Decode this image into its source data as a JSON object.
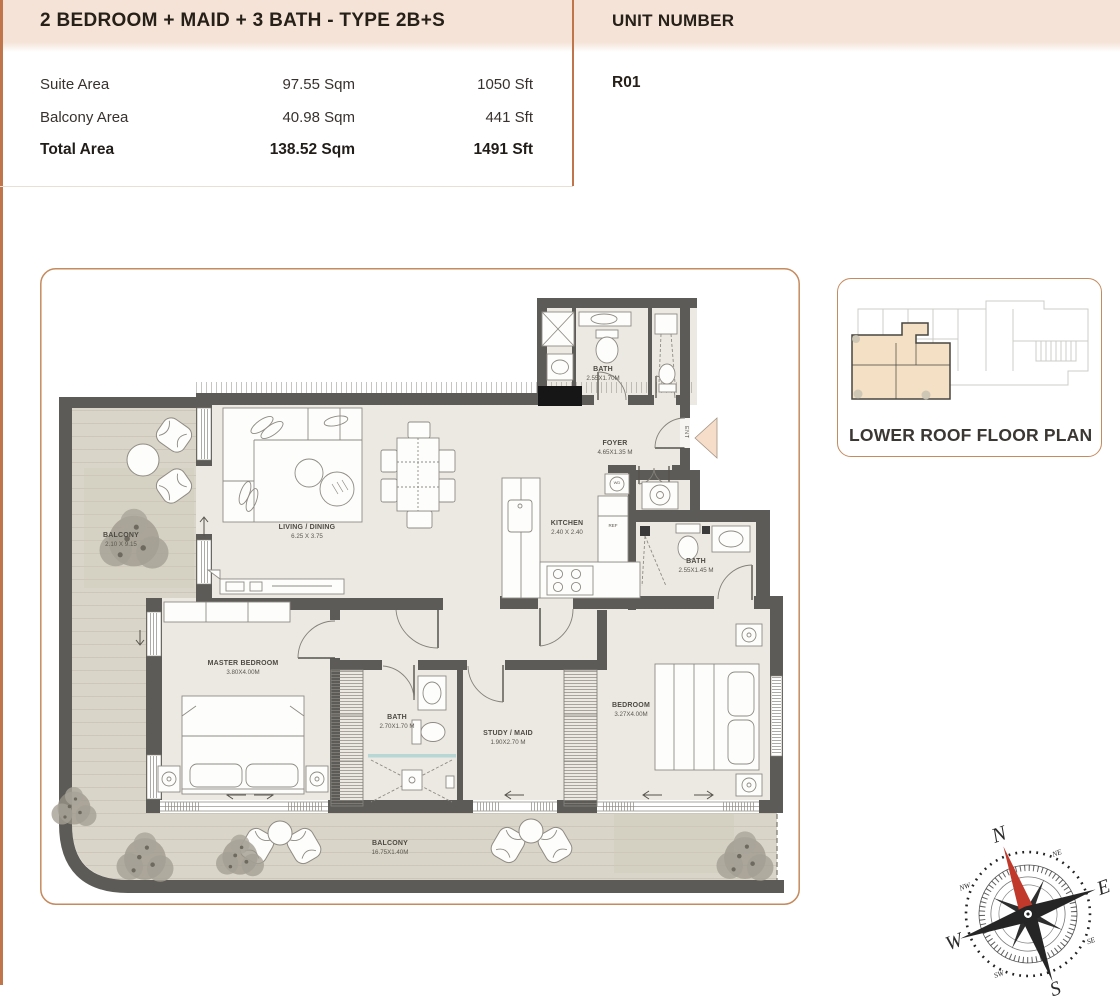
{
  "header": {
    "title": "2 BEDROOM  + MAID + 3 BATH - TYPE 2B+S",
    "unit": {
      "label": "UNIT NUMBER",
      "value": "R01"
    },
    "area_rows": [
      {
        "label": "Suite Area",
        "sqm": "97.55 Sqm",
        "sft": "1050 Sft"
      },
      {
        "label": "Balcony Area",
        "sqm": "40.98 Sqm",
        "sft": "441 Sft"
      },
      {
        "label": "Total Area",
        "sqm": "138.52 Sqm",
        "sft": "1491 Sft"
      }
    ]
  },
  "key_plan": {
    "caption": "LOWER ROOF FLOOR PLAN"
  },
  "compass": {
    "n": "N",
    "e": "E",
    "s": "S",
    "w": "W",
    "ne": "NE",
    "se": "SE",
    "sw": "SW",
    "nw": "NW"
  },
  "plan": {
    "rooms": {
      "balcony_left": {
        "name": "BALCONY",
        "dim": "2.10 X 9.15"
      },
      "living": {
        "name": "LIVING / DINING",
        "dim": "6.25 X 3.75"
      },
      "bath_top": {
        "name": "BATH",
        "dim": "2.55X1.70M"
      },
      "foyer": {
        "name": "FOYER",
        "dim": "4.65X1.35 M"
      },
      "kitchen": {
        "name": "KITCHEN",
        "dim": "2.40 X 2.40"
      },
      "bath_right": {
        "name": "BATH",
        "dim": "2.55X1.45 M"
      },
      "master_bedroom": {
        "name": "MASTER BEDROOM",
        "dim": "3.80X4.00M"
      },
      "bath_mid": {
        "name": "BATH",
        "dim": "2.70X1.70 M"
      },
      "study": {
        "name": "STUDY / MAID",
        "dim": "1.90X2.70 M"
      },
      "bedroom": {
        "name": "BEDROOM",
        "dim": "3.27X4.00M"
      },
      "balcony_bottom": {
        "name": "BALCONY",
        "dim": "16.75X1.40M"
      }
    },
    "markers": {
      "entrance": "ENT",
      "fridge": "REF",
      "washer": "WD"
    }
  },
  "colors": {
    "accent": "#c0754a",
    "wall": "#5d5b57",
    "floor": "#ebe9e2",
    "balcony": "#d9d5c8",
    "keyplan_unit": "#f3e0c5",
    "north": "#c0392b"
  }
}
